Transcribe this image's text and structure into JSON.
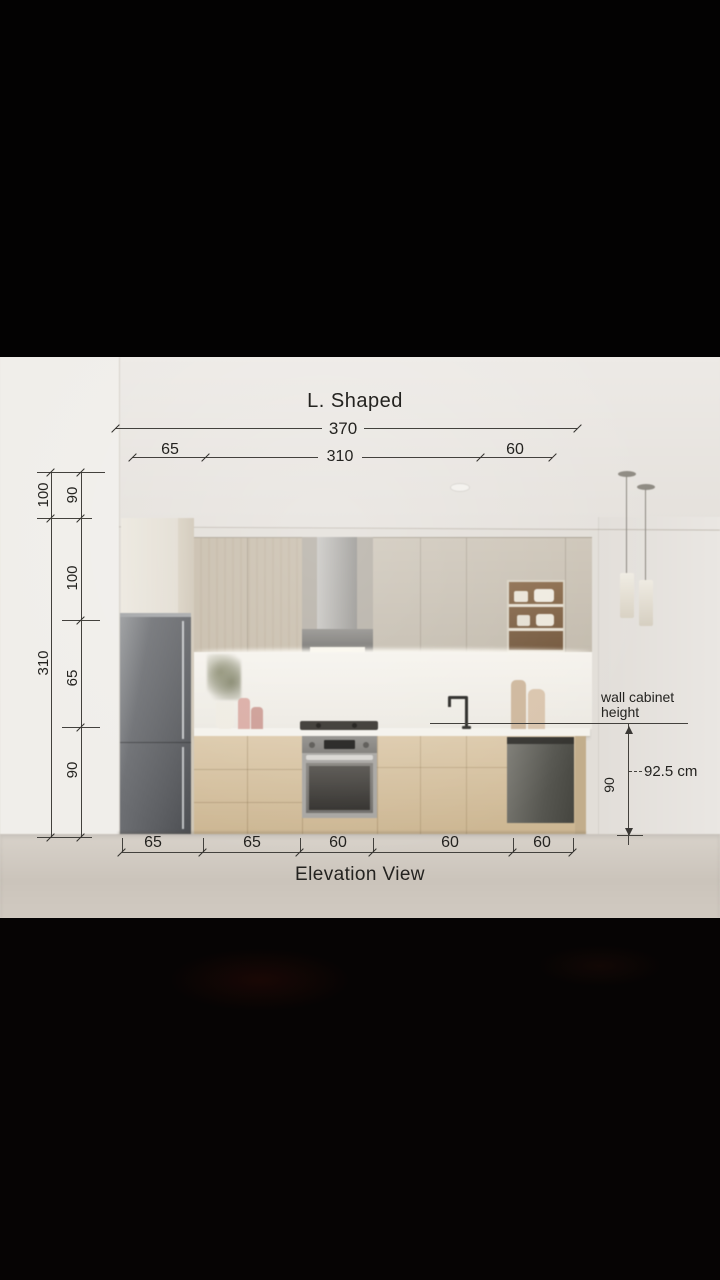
{
  "title": "L. Shaped",
  "caption": "Elevation View",
  "top_dims": {
    "total": "370",
    "segments": [
      "65",
      "310",
      "60"
    ]
  },
  "left_dims": {
    "outer": [
      "100",
      "310"
    ],
    "inner": [
      "90",
      "100",
      "65",
      "90"
    ]
  },
  "bottom_dims": [
    "65",
    "65",
    "60",
    "60",
    "60"
  ],
  "right_dims": {
    "annotation": [
      "wall cabinet",
      "height"
    ],
    "value": "92.5 cm",
    "height": "90"
  },
  "colors": {
    "dimension_line": "#43413d",
    "dimension_text": "#242320",
    "letterbox": "#040303",
    "wall": "#e4e0db",
    "cabinet_greige": "#c8c0b2",
    "cabinet_wood": "#d7c3a3",
    "stainless": "#5b5d61",
    "countertop": "#f4f2ec",
    "floor": "#d2cbc2"
  }
}
